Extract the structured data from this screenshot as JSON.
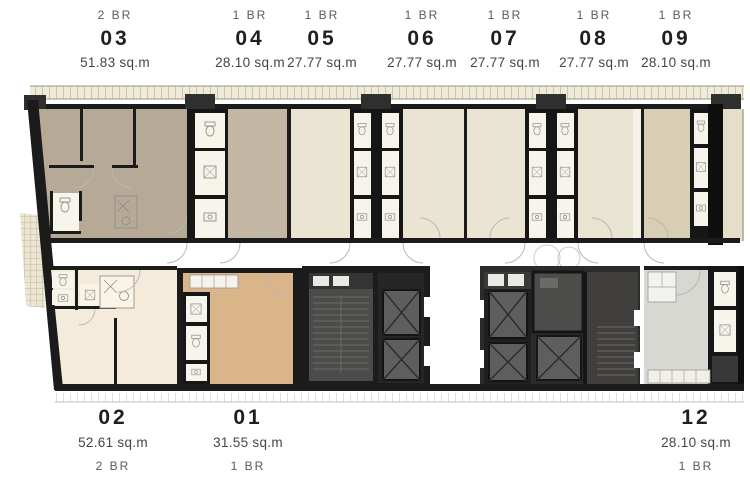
{
  "plan_title": "residential floor plan",
  "units": {
    "u03": {
      "number": "03",
      "bedrooms": "2 BR",
      "area": "51.83 sq.m"
    },
    "u04": {
      "number": "04",
      "bedrooms": "1 BR",
      "area": "28.10 sq.m"
    },
    "u05": {
      "number": "05",
      "bedrooms": "1 BR",
      "area": "27.77 sq.m"
    },
    "u06": {
      "number": "06",
      "bedrooms": "1 BR",
      "area": "27.77 sq.m"
    },
    "u07": {
      "number": "07",
      "bedrooms": "1 BR",
      "area": "27.77 sq.m"
    },
    "u08": {
      "number": "08",
      "bedrooms": "1 BR",
      "area": "27.77 sq.m"
    },
    "u09": {
      "number": "09",
      "bedrooms": "1 BR",
      "area": "28.10 sq.m"
    },
    "u02": {
      "number": "02",
      "bedrooms": "2 BR",
      "area": "52.61 sq.m"
    },
    "u01": {
      "number": "01",
      "bedrooms": "1 BR",
      "area": "31.55 sq.m"
    },
    "u12": {
      "number": "12",
      "bedrooms": "1 BR",
      "area": "28.10 sq.m"
    }
  },
  "colors": {
    "u03": "#b6a995",
    "u04": "#c3b6a2",
    "u05": "#eae4d3",
    "u06": "#eae4d3",
    "u07": "#eae4d3",
    "u08": "#e9e3d1",
    "u09": "#d8ceb4",
    "u02": "#f5ebdb",
    "u01": "#dab58a",
    "u12": "#d7d8d2",
    "wall": "#1b1b1b",
    "core_dark": "#242424",
    "stair_room": "#4b4b49",
    "elevator": "#5e5e5e",
    "bath_cell": "#f7f4ec",
    "corridor": "#ffffff",
    "balcony_band": "#f0ead9",
    "outer_strip": "#e5dec8"
  }
}
